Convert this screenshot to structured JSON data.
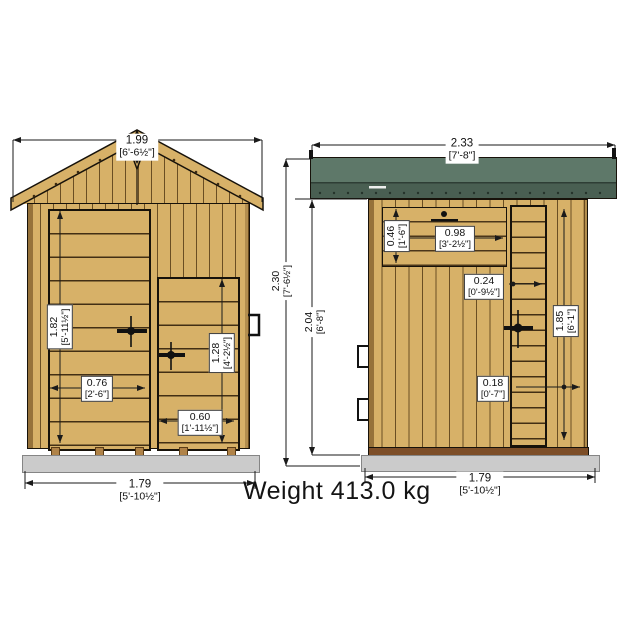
{
  "front_view": {
    "roof_width": {
      "m": "1.99",
      "ft": "[6'-6½\"]"
    },
    "door_height": {
      "m": "1.82",
      "ft": "[5'-11½\"]"
    },
    "door_width": {
      "m": "0.76",
      "ft": "[2'-6\"]"
    },
    "store_door_height": {
      "m": "1.28",
      "ft": "[4'-2½\"]"
    },
    "store_door_width": {
      "m": "0.60",
      "ft": "[1'-11½\"]"
    },
    "base_width": {
      "m": "1.79",
      "ft": "[5'-10½\"]"
    }
  },
  "side_view": {
    "overall_width": {
      "m": "2.33",
      "ft": "[7'-8\"]"
    },
    "ridge_height": {
      "m": "2.30",
      "ft": "[7'-6½\"]"
    },
    "eaves_height": {
      "m": "2.04",
      "ft": "[6'-8\"]"
    },
    "vent_height": {
      "m": "0.46",
      "ft": "[1'-6\"]"
    },
    "vent_width": {
      "m": "0.98",
      "ft": "[3'-2½\"]"
    },
    "door_panel_width": {
      "m": "0.24",
      "ft": "[0'-9½\"]"
    },
    "door_height": {
      "m": "1.85",
      "ft": "[6'-1\"]"
    },
    "side_strip_width": {
      "m": "0.18",
      "ft": "[0'-7\"]"
    },
    "base_depth": {
      "m": "1.79",
      "ft": "[5'-10½\"]"
    }
  },
  "weight_label": "Weight 413.0 kg",
  "colors": {
    "wood": "#d7b168",
    "roof_green_top": "#5e7869",
    "roof_green_bottom": "#495f52",
    "slab_grey": "#cbcbcb",
    "floor_brown": "#7d4e28",
    "line": "#1a1a1a"
  }
}
